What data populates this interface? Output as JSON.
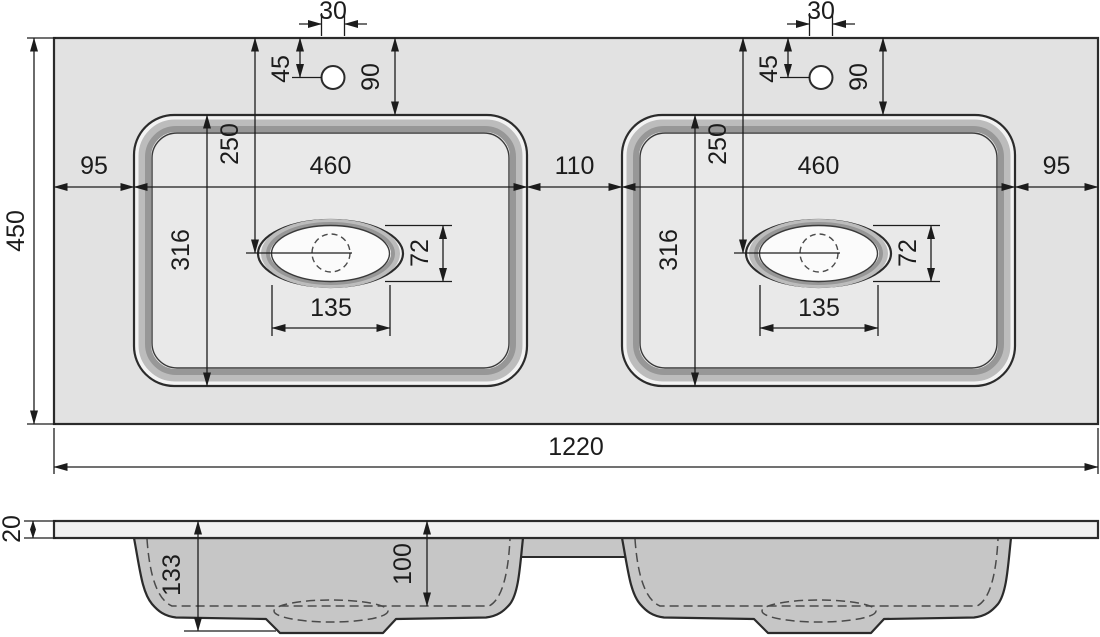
{
  "drawing": {
    "subject": "double washbasin countertop technical drawing, plan view and cross-section"
  },
  "colors": {
    "background": "#ffffff",
    "countertop_fill": "#e2e2e2",
    "rim_fill": "#f3f3f3",
    "floor_fill": "#e9e9e9",
    "oval_floor_fill": "#fbfbfb",
    "slab_fill": "#f0f0f0",
    "basin_section_fill": "#c6c6c6",
    "bevel_mid": "#bcbcbc",
    "bevel_dark": "#979797",
    "line": "#2b2b2b",
    "dim_color": "#1c1c1c"
  },
  "plan_view": {
    "overall_width": "1220",
    "overall_depth": "450",
    "margin_left": "95",
    "margin_right": "95",
    "basin_left_width": "460",
    "basin_right_width": "460",
    "basin_gap": "110",
    "basin_left_depth": "316",
    "basin_right_depth": "316",
    "faucet_hole_dia_left": "30",
    "faucet_hole_dia_right": "30",
    "faucet_hole_offset_left": "45",
    "faucet_hole_offset_right": "45",
    "back_margin_left": "90",
    "back_margin_right": "90",
    "drain_offset_left": "250",
    "drain_offset_right": "250",
    "drain_recess_length_left": "135",
    "drain_recess_length_right": "135",
    "drain_recess_width_left": "72",
    "drain_recess_width_right": "72"
  },
  "section_view": {
    "slab_thickness": "20",
    "overall_basin_depth": "133",
    "bowl_inner_depth": "100"
  }
}
